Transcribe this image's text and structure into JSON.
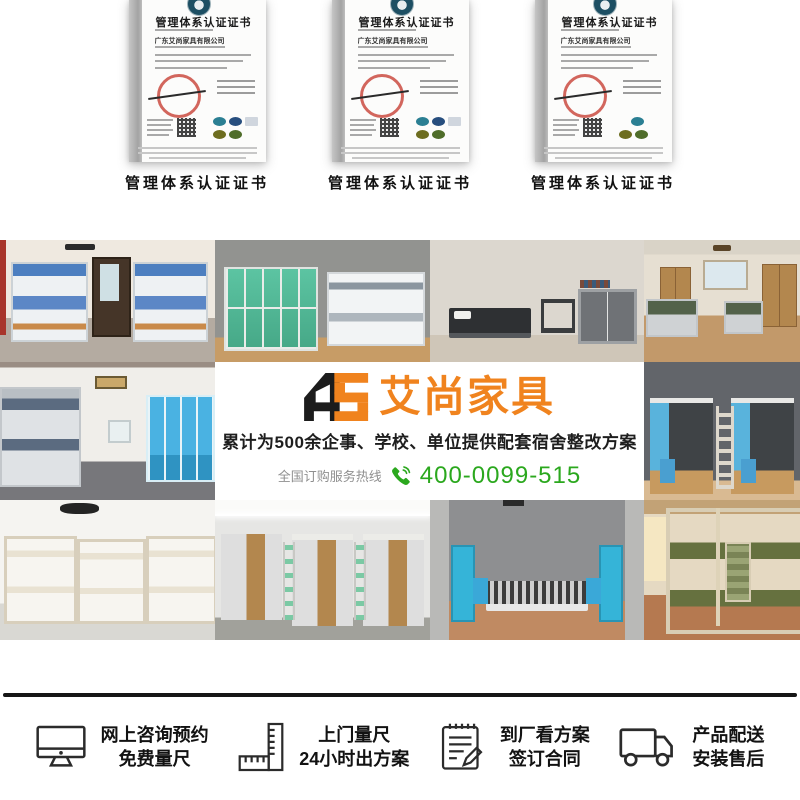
{
  "certificates": {
    "items": [
      {
        "title": "管理体系认证证书",
        "company": "广东艾尚家具有限公司",
        "caption": "管理体系认证证书",
        "seal": "red-seal",
        "qr": "qr-code"
      },
      {
        "title": "管理体系认证证书",
        "company": "广东艾尚家具有限公司",
        "caption": "管理体系认证证书",
        "seal": "red-seal",
        "qr": "qr-code"
      },
      {
        "title": "管理体系认证证书",
        "company": "广东艾尚家具有限公司",
        "caption": "管理体系认证证书",
        "seal": "red-seal",
        "qr": "qr-code"
      }
    ]
  },
  "banner": {
    "logo_mark": "AS",
    "logo_text": "艾尚家具",
    "tagline": "累计为500余企事、学校、单位提供配套宿舍整改方案",
    "hotline_label": "全国订购服务热线",
    "hotline_icon": "phone-icon",
    "phone_number": "400-0099-515",
    "colors": {
      "brand_orange": "#F0831E",
      "brand_green": "#2BA81E"
    }
  },
  "gallery": {
    "photos": [
      {
        "name": "dorm-blue-bunk-beds-with-desks"
      },
      {
        "name": "teal-lockers-and-bunk-bed"
      },
      {
        "name": "single-bed-desk-and-cabinet-room"
      },
      {
        "name": "wooden-wardrobe-dorm-room"
      },
      {
        "name": "gray-bunks-and-blue-cabinet-room"
      },
      {
        "name": "dark-loft-bed-units-with-blue-wardrobes"
      },
      {
        "name": "cream-bunk-beds-room"
      },
      {
        "name": "loft-beds-with-wooden-doors-and-desks"
      },
      {
        "name": "platform-beds-with-teal-cabinets"
      },
      {
        "name": "green-metal-bunk-frames-room"
      }
    ]
  },
  "services": {
    "items": [
      {
        "icon": "monitor-icon",
        "line1": "网上咨询预约",
        "line2": "免费量尺"
      },
      {
        "icon": "ruler-icon",
        "line1": "上门量尺",
        "line2": "24小时出方案"
      },
      {
        "icon": "contract-pen-icon",
        "line1": "到厂看方案",
        "line2": "签订合同"
      },
      {
        "icon": "delivery-truck-icon",
        "line1": "产品配送",
        "line2": "安装售后"
      }
    ]
  }
}
